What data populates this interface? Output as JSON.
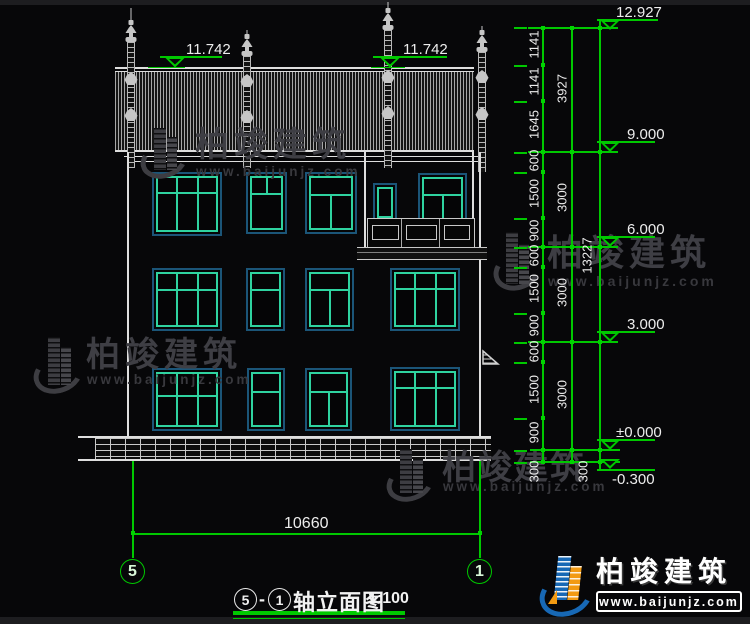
{
  "drawing": {
    "title": {
      "axis_start": "5",
      "separator": "-",
      "axis_end": "1",
      "name": "轴立面图",
      "scale": "1:100"
    },
    "axis_bubbles": {
      "left": "5",
      "right": "1"
    },
    "width_dim": "10660",
    "roof_elevation_left": "11.742",
    "roof_elevation_right": "11.742",
    "elevations": [
      "12.927",
      "9.000",
      "6.000",
      "3.000",
      "±0.000",
      "-0.300"
    ],
    "dim_chain_detail": [
      "1141",
      "1141",
      "1645",
      "600",
      "1500",
      "900",
      "600",
      "1500",
      "900",
      "600",
      "1500",
      "900",
      "300"
    ],
    "dim_chain_floors": [
      "3927",
      "3000",
      "3000",
      "3000",
      "300"
    ],
    "dim_total": "13227"
  },
  "watermark": {
    "brand": "柏竣建筑",
    "url": "www.baijunjz.com"
  },
  "logo": {
    "brand": "柏竣建筑",
    "url": "www.baijunjz.com"
  }
}
